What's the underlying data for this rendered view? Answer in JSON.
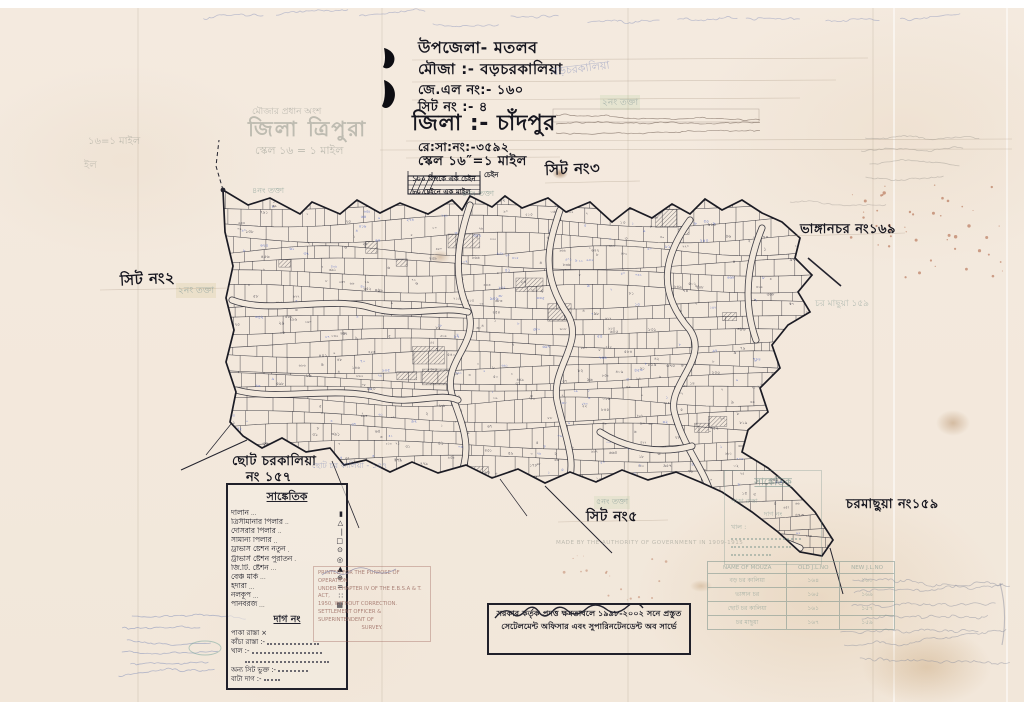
{
  "page": {
    "paper_color": "#f3e9dd",
    "ink_color": "#23232e",
    "blue_color": "#3a55c0",
    "teal_color": "#6f8d86"
  },
  "header": {
    "upazila": "উপজেলা- মতলব",
    "mouza": "মৌজা :-   বড়চরকালিয়া",
    "jl_no": "জে.এল নং:- ১৬০",
    "sheet_no": "সিট নং :-        ৪",
    "district": "জিলা :-   চাঁদপুর",
    "resa_no": "রে:সা:নং:-৩৫৯২",
    "scale": "স্কেল ১৬″=১ মাইল",
    "chain_note1": "১০০ লিংকে এক চেইন",
    "chain_note2": "৮০ চেইনে এক মাইল",
    "sheet3": "সিট নং৩",
    "chain_label": "চেইন"
  },
  "annotations": {
    "sheet2": "সিট নং২",
    "sheet5": "সিট নং৫",
    "bhanganchar": "ভাঙ্গানচর নং১৬৯",
    "charmachhua": "চরমাছুয়া নং১৫৯",
    "chhoto_line1": "ছোট চরকালিয়া",
    "chhoto_line2": "নং ১৫৭"
  },
  "faded_print": {
    "district_tripura": "জিলা ত্রিপুরা",
    "tripura_scale": "স্কেল ১৬ = ১ মাইল",
    "mouza_top": "মৌজার প্রধান অংশ",
    "left_frag1": "১৬=১ মাইল",
    "left_frag2": "ইল",
    "board2": "২নং তক্তা",
    "board4": "৪নং তক্তা",
    "board4b": "৪নং তক্তা",
    "board5": "৫নং তক্তা",
    "boro_pencil": "বড়চরকালিয়া",
    "chhoto_pencil": "ছোট চর কালিয়া - ১৫৭",
    "charbachhua_pencil": "চর মাছুয়া  ১৫৯",
    "authority": "MADE BY THE AUTHORITY OF GOVERNMENT IN 1909-1915"
  },
  "legend": {
    "title": "সাঙ্কেতিক",
    "items": [
      {
        "label": "দালান",
        "symbol": "▮"
      },
      {
        "label": "ত্রিসীমানার পিলার",
        "symbol": "△"
      },
      {
        "label": "দোসরার পিলার",
        "symbol": "|"
      },
      {
        "label": "সামান্য পিলার",
        "symbol": "□"
      },
      {
        "label": "ট্রাভার্স ষ্টেশন নতুন",
        "symbol": "⊙"
      },
      {
        "label": "ট্রাভার্স ষ্টেশন পুরাতন",
        "symbol": "◎"
      },
      {
        "label": "জি.টি. ষ্টেশন",
        "symbol": "▲"
      },
      {
        "label": "বেঞ্চ মার্ক",
        "symbol": "⊕"
      },
      {
        "label": "ইদারা",
        "symbol": "="
      },
      {
        "label": "নলকূপ",
        "symbol": "∷"
      },
      {
        "label": "পানবরজ",
        "symbol": "▦"
      }
    ],
    "dag_title": "দাগ নং",
    "dag_rows": [
      "পাকা রাস্তা ×",
      "কাঁচা রাস্তা :-",
      "খাল :-",
      "অন্য সিট ভুক্ত :-",
      "বাটা দাগ :-"
    ]
  },
  "stamp_en": {
    "line1": "PRINTED FOR THE PURPOSE OF OPERATION",
    "line2": "UNDER CHAPTER IV OF THE E.B.S.A & T. ACT,",
    "line3": "1950, WITHOUT CORRECTION.",
    "line4": "SETTLEMENT OFFICER & SUPERINTENDENT OF",
    "line5": "SURVEY."
  },
  "stamp_bn": {
    "line1": "সরকার কর্তৃক প্রদত্ত ক্ষমতাবলে ১৯৯৮-২০০২ সনে প্রস্তুত",
    "line2": "সেটেলমেন্ট অফিসার এবং সুপারিনটেনডেন্ট অব সার্ভে"
  },
  "jl_table": {
    "headers": [
      "NAME OF MOUZA",
      "OLD J.L.NO",
      "NEW J.L.NO"
    ],
    "rows": [
      {
        "name": "বড় চর কালিয়া",
        "old": "১৬৪",
        "new": "১৬০"
      },
      {
        "name": "ভাঙ্গান চর",
        "old": "১৬৫",
        "new": "১৬৯"
      },
      {
        "name": "ছোট চর কালিয়া",
        "old": "১৬১",
        "new": "১৫৭"
      },
      {
        "name": "চর মাছুয়া",
        "old": "১৬৭",
        "new": "১৫৯"
      }
    ]
  },
  "fade_box": {
    "title": "সাঙ্কেতিক",
    "row1": "পাকা রাস্তা",
    "row2": "দাগ নং",
    "row3": "খাল :"
  }
}
